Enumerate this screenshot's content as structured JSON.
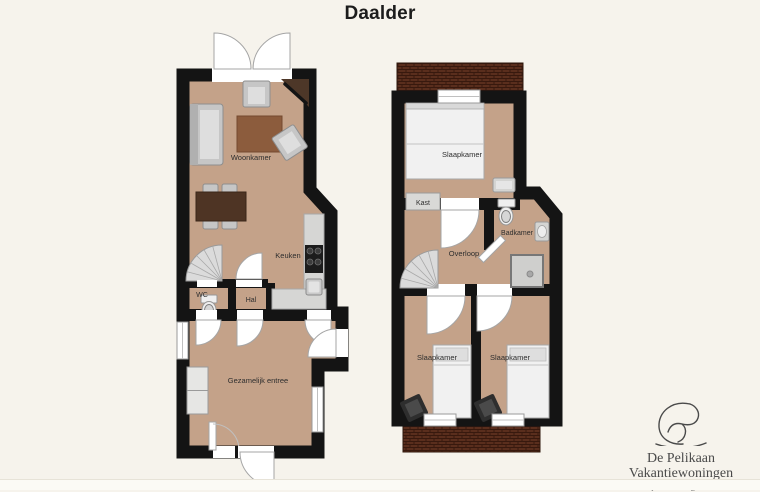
{
  "title": "Daalder",
  "colors": {
    "background": "#f6f3ec",
    "floor": "#c4a289",
    "wall": "#141414",
    "brick": "#5a2e1d",
    "brick_mortar": "#38190e",
    "counter_grey": "#d6d6d4",
    "wood_dark": "#4e3424",
    "rug_brown": "#8c5c3d"
  },
  "ground_floor": {
    "labels": {
      "woonkamer": "Woonkamer",
      "keuken": "Keuken",
      "wc": "WC",
      "hal": "Hal",
      "entree": "Gezamelijk entree"
    }
  },
  "upper_floor": {
    "labels": {
      "slaapkamer_main": "Slaapkamer",
      "kast": "Kast",
      "overloop": "Overloop",
      "badkamer": "Badkamer",
      "slaapkamer_left": "Slaapkamer",
      "slaapkamer_right": "Slaapkamer"
    }
  },
  "logo": {
    "line1": "De Pelikaan",
    "line2": "Vakantiewoningen",
    "tagline": "Comfortabel genieten"
  }
}
